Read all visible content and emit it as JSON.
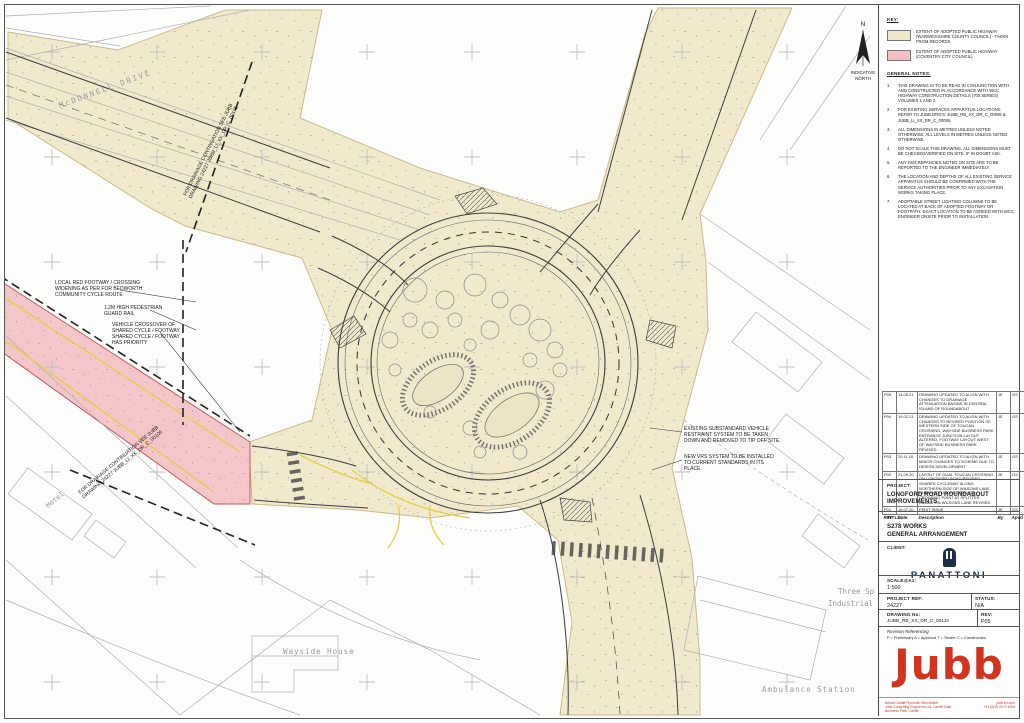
{
  "key": {
    "title": "KEY:",
    "items": [
      {
        "label": "EXTENT OF ADOPTED PUBLIC HIGHWAY (WARWICKSHIRE COUNTY COUNCIL) - TAKEN FROM RECORDS",
        "color": "#EFE7C6"
      },
      {
        "label": "EXTENT OF ADOPTED PUBLIC HIGHWAY (COVENTRY CITY COUNCIL)",
        "color": "#F4BEC2"
      }
    ]
  },
  "general_notes": {
    "title": "GENERAL NOTES:",
    "items": [
      "THIS DRAWING IS TO BE READ IN CONJUNCTION WITH AND CONSTRUCTED IN ACCORDANCE WITH WCC HIGHWAY CONSTRUCTION DETAILS (700 SERIES) VOLUMES 1 AND 2.",
      "FOR EXISTING SERVICES APPARATUS LOCATIONS REFER TO JUBB DRG'S: JUBB_RB_XX_DR_C_00095 & JUBB_LI_XX_DR_C_00095.",
      "ALL DIMENSIONS IN METRES UNLESS NOTED OTHERWISE. ALL LEVELS IN METRES UNLESS NOTED OTHERWISE.",
      "DO NOT SCALE THIS DRAWING. ALL DIMENSIONS MUST BE CHECKED/VERIFIED ON SITE. IF IN DOUBT ASK.",
      "ANY DISCREPANCIES NOTED ON SITE ARE TO BE REPORTED TO THE ENGINEER IMMEDIATELY.",
      "THE LOCATION AND DEPTHS OF ALL EXISTING SERVICE APPARATUS SHOULD BE CONFIRMED WITH THE SERVICE AUTHORITIES PRIOR TO ANY EXCAVATION WORKS TAKING PLACE.",
      "ADOPTABLE STREET LIGHTING COLUMNS TO BE LOCATED AT BACK OF ADOPTED FOOTWAY OR FOOTPATH. EXACT LOCATION TO BE AGREED WITH WCC ENGINEER ONSITE PRIOR TO INSTALLATION."
    ]
  },
  "revision_table": {
    "headers": [
      "Rev",
      "Date",
      "Description",
      "By",
      "Apvd"
    ],
    "rows": [
      {
        "rev": "P05",
        "date": "14.05.21",
        "desc": "DRAWING UPDATED TO ALIGN WITH CHANGES TO DRAINAGE ATTENUATION BASINS IN CENTRAL ISLAND OF ROUNDABOUT",
        "by": "JE",
        "apvd": "GS"
      },
      {
        "rev": "P04",
        "date": "19.02.21",
        "desc": "DRAWING UPDATED TO ALIGN WITH CHANGES TO REVISED POSITION OF WESTERN SIDE OF TOUCAN CROSSING, WAYSIDE BUSINESS PARK ENTRANCE JUNCTION LAYOUT ALTERED, FOOTWAY LAYOUT WEST OF WAYSIDE BUSINESS PARK REVISED",
        "by": "JE",
        "apvd": "GS"
      },
      {
        "rev": "P03",
        "date": "20.11.20",
        "desc": "DRAWING UPDATED TO ALIGN WITH MINOR CHANGES TO SCHEME DUE TO DESIGN DEVELOPMENT",
        "by": "JE",
        "apvd": "GS"
      },
      {
        "rev": "P02",
        "date": "21.09.20",
        "desc": "LAYOUT OF DUAL TOUCAN CROSSING ON LONGFORD ROAD REVISED, SHARED CYCLEWAY ALONG NORTHERN SIDE OF WILSONS LANE CHANGED, UNCONTROLLED CROSSING POINT AT SPLITTER ISLAND ON WILSONS LANE REVISED",
        "by": "JE",
        "apvd": "GS"
      },
      {
        "rev": "P01",
        "date": "16.07.20",
        "desc": "FIRST ISSUE",
        "by": "JE",
        "apvd": "GS"
      }
    ]
  },
  "title_block": {
    "project_label": "PROJECT:",
    "project_name": "LONGFORD ROAD ROUNDABOUT IMPROVEMENTS",
    "title_label": "TITLE:",
    "title_line1": "S278 WORKS",
    "title_line2": "GENERAL ARRANGEMENT",
    "client_label": "CLIENT:",
    "client_name": "PANATTONI",
    "scale_label": "SCALE@A1:",
    "scale_value": "1:500",
    "project_ref_label": "PROJECT REF:",
    "project_ref": "24227",
    "status_label": "STATUS:",
    "status": "N/A",
    "drawing_no_label": "DRAWING No:",
    "drawing_no": "JUBB_RB_XX_DR_C_00110",
    "rev_label": "REV:",
    "rev": "P05",
    "revision_ref_title": "Revision Referencing",
    "revision_ref_text": "P = Preliminary A = Approval T = Tender C = Construction",
    "logo_text": "Jubb",
    "footer_left1": "Bristol  Cardiff  Plymouth  Winchester",
    "footer_left2": "Jubb Consulting Engineers Ltd, Cardiff Gate Business Park, Cardiff",
    "footer_right1": "jubb.eu.com",
    "footer_right2": "+44 (0)29 2073 4254"
  },
  "map": {
    "labels": {
      "mcdonnell_drive": "McDONNELL  DRIVE",
      "hotel": "Hotel",
      "wayside_house": "Wayside House",
      "ambulance_station": "Ambulance Station",
      "three_spires_1": "Three Sp",
      "three_spires_2": "Industrial",
      "north_n": "N",
      "indicative_1": "INDICATIVE",
      "indicative_2": "NORTH"
    },
    "annotations": {
      "drainage_top": [
        "FOR DRAINAGE CONTINUATION SEE JUBB",
        "DRAWING 24227 JUBB_LI_XX_DR_C_00105"
      ],
      "drainage_bottom": [
        "FOR DRAINAGE CONTINUATION SEE JUBB",
        "DRAWING 24227 JUBB_LI_XX_DR_C_00106"
      ],
      "local_footway": [
        "LOCAL RED FOOTWAY / CROSSING",
        "WIDENING AS PER FOR BEDWORTH",
        "COMMUNITY CYCLE ROUTE"
      ],
      "guard_rail": [
        "1.2M HIGH PEDESTRIAN",
        "GUARD RAIL"
      ],
      "verge_crossover": [
        "VEHICLE CROSSOVER OF",
        "SHARED CYCLE / FOOTWAY.",
        "SHARED CYCLE / FOOTWAY",
        "HAS PRIORITY"
      ],
      "vrs_existing": [
        "EXISTING SUBSTANDARD VEHICLE",
        "RESTRAINT SYSTEM TO BE TAKEN",
        "DOWN AND REMOVED TO TIP OFF SITE."
      ],
      "vrs_new": [
        "NEW VRS SYSTEM TO BE INSTALLED",
        "TO CURRENT STANDARDS IN ITS",
        "PLACE."
      ]
    }
  },
  "colors": {
    "warwickshire_highway": "#EFE7C6",
    "coventry_highway": "#F4BEC2",
    "jubb_red": "#D2351F",
    "panattoni_navy": "#1F2C49",
    "yellow_marking": "#E3CF45"
  }
}
